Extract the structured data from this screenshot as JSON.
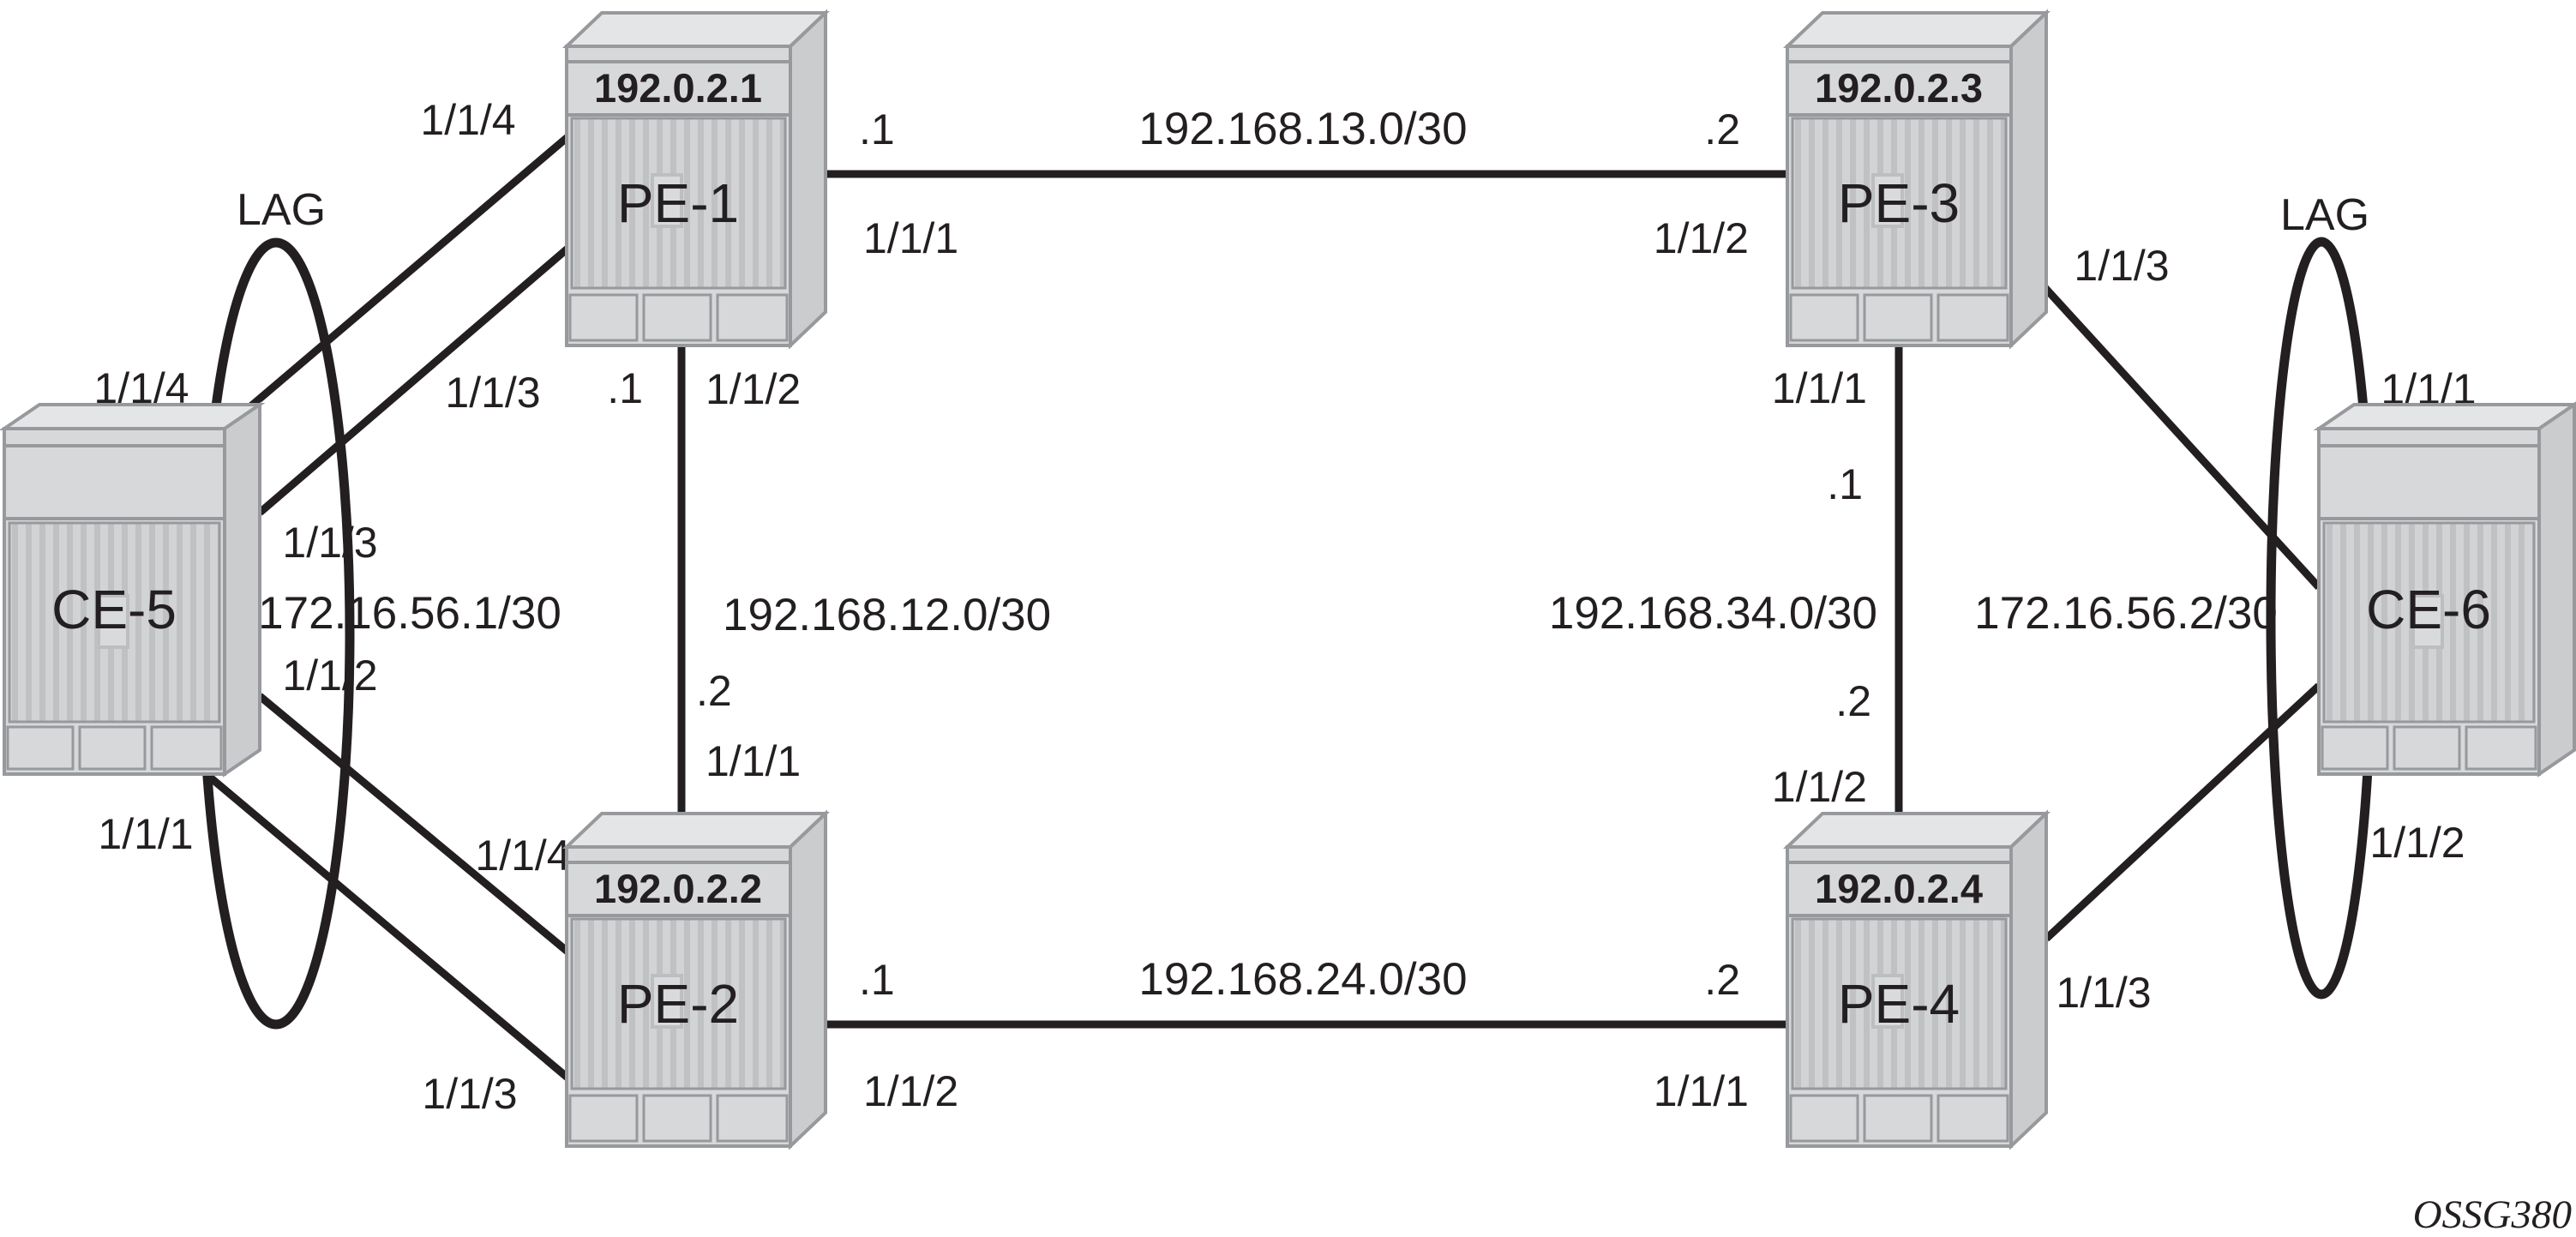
{
  "figure_code": "OSSG380",
  "nodes": {
    "pe1": {
      "name": "PE-1",
      "ip": "192.0.2.1"
    },
    "pe2": {
      "name": "PE-2",
      "ip": "192.0.2.2"
    },
    "pe3": {
      "name": "PE-3",
      "ip": "192.0.2.3"
    },
    "pe4": {
      "name": "PE-4",
      "ip": "192.0.2.4"
    },
    "ce5": {
      "name": "CE-5"
    },
    "ce6": {
      "name": "CE-6"
    }
  },
  "core_links": {
    "pe1_pe3": {
      "subnet": "192.168.13.0/30",
      "left_addr": ".1",
      "right_addr": ".2",
      "left_port": "1/1/1",
      "right_port": "1/1/2"
    },
    "pe1_pe2": {
      "subnet": "192.168.12.0/30",
      "top_addr": ".1",
      "bottom_addr": ".2",
      "top_port": "1/1/2",
      "bottom_port": "1/1/1"
    },
    "pe2_pe4": {
      "subnet": "192.168.24.0/30",
      "left_addr": ".1",
      "right_addr": ".2",
      "left_port": "1/1/2",
      "right_port": "1/1/1"
    },
    "pe3_pe4": {
      "subnet": "192.168.34.0/30",
      "top_addr": ".1",
      "bottom_addr": ".2",
      "top_port": "1/1/1",
      "bottom_port": "1/1/2"
    }
  },
  "access_left": {
    "lag_label": "LAG",
    "subnet": "172.16.56.1/30",
    "ce5_port_to_pe1_a": "1/1/4",
    "ce5_port_to_pe1_b": "1/1/3",
    "ce5_port_to_pe2_a": "1/1/2",
    "ce5_port_to_pe2_b": "1/1/1",
    "pe1_port_a": "1/1/4",
    "pe1_port_b": "1/1/3",
    "pe2_port_a": "1/1/4",
    "pe2_port_b": "1/1/3"
  },
  "access_right": {
    "lag_label": "LAG",
    "subnet": "172.16.56.2/30",
    "pe3_port": "1/1/3",
    "pe4_port": "1/1/3",
    "ce6_port_to_pe3": "1/1/1",
    "ce6_port_to_pe4": "1/1/2"
  }
}
